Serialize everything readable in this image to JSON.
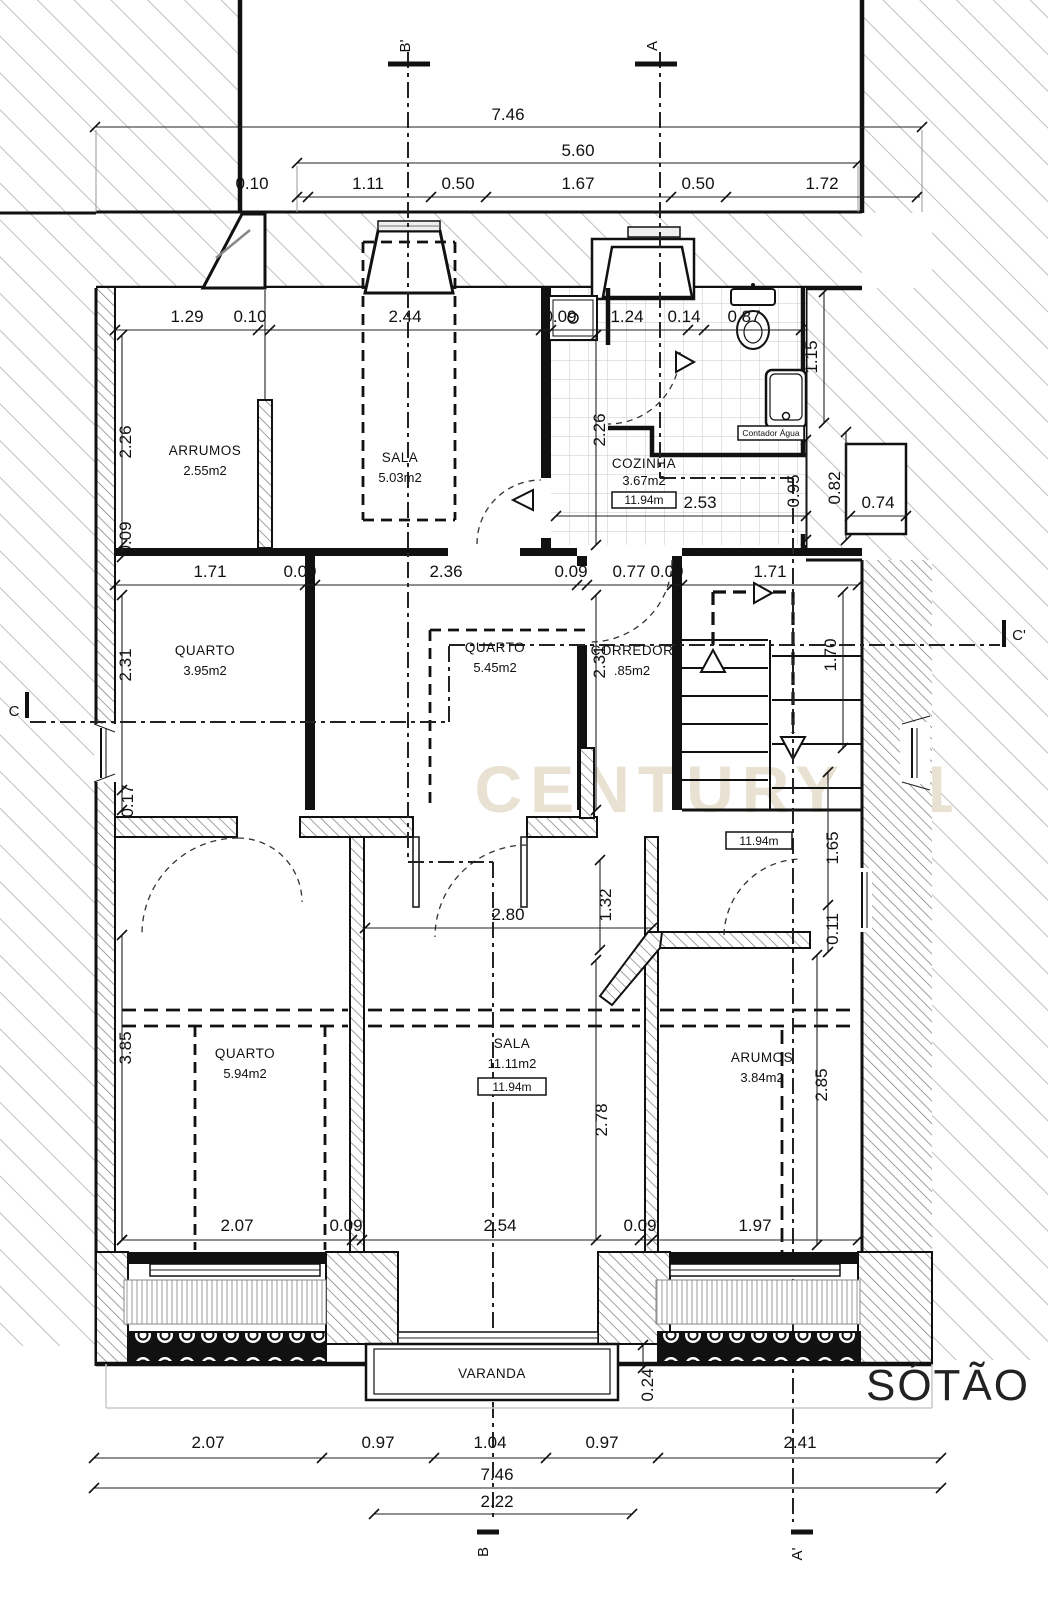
{
  "drawing": {
    "floor_label": "SÓTÃO",
    "watermark": "CENTURY 21",
    "rooms": {
      "arrumos_top": {
        "name": "ARRUMOS",
        "area": "2.55m2"
      },
      "sala_top": {
        "name": "SALA",
        "area": "5.03m2"
      },
      "cozinha": {
        "name": "COZINHA",
        "area": "3.67m2",
        "ceiling_height": "11.94m"
      },
      "quarto_nw": {
        "name": "QUARTO",
        "area": "3.95m2"
      },
      "quarto_mid": {
        "name": "QUARTO",
        "area": "5.45m2"
      },
      "corredor": {
        "name": "CORREDOR",
        "area": ".85m2"
      },
      "hall": {
        "ceiling_height": "11.94m"
      },
      "quarto_sw": {
        "name": "QUARTO",
        "area": "5.94m2"
      },
      "sala_main": {
        "name": "SALA",
        "area": "11.11m2",
        "ceiling_height": "11.94m"
      },
      "arumos": {
        "name": "ARUMOS",
        "area": "3.84m2"
      },
      "varanda": {
        "name": "VARANDA"
      }
    },
    "annotations": {
      "water_meter": "Contador Água"
    },
    "section_markers": {
      "b_top": "B'",
      "a_top": "A",
      "c_left": "C",
      "c_right": "C'",
      "b_bottom": "B",
      "a_bottom": "A'"
    },
    "dimensions": {
      "total_width_top": "7.46",
      "inner_width_top": "5.60",
      "row_top": [
        "0.10",
        "1.11",
        "0.50",
        "1.67",
        "0.50",
        "1.72"
      ],
      "row_upper": [
        "1.29",
        "0.10",
        "2.44",
        "0.09",
        "1.24",
        "0.14",
        "0.87"
      ],
      "v_left_upper": [
        "2.26",
        "0.09"
      ],
      "v_mid_upper": "2.26",
      "v_right_upper": [
        "1.15",
        "0.95",
        "0.82"
      ],
      "kitchen_width": "2.53",
      "alcove_width": "0.74",
      "row_mid": [
        "1.71",
        "0.09",
        "2.36",
        "0.09",
        "0.77",
        "0.09",
        "1.71"
      ],
      "v_left_mid": [
        "2.31",
        "0.17"
      ],
      "v_mid_mid": "2.31",
      "stair_depth": "1.70",
      "v_low": [
        "1.32",
        "1.65",
        "0.11",
        "3.85",
        "2.78",
        "2.85"
      ],
      "opening_width": "2.80",
      "balcony_depth": "0.24",
      "row_lower": [
        "2.07",
        "0.09",
        "2.54",
        "0.09",
        "1.97"
      ],
      "row_bottom": [
        "2.07",
        "0.97",
        "1.04",
        "0.97",
        "2.41"
      ],
      "total_width_bottom": "7.46",
      "balcony_door_width": "2.22"
    },
    "colors": {
      "ink": "#1a1a1a",
      "hatch": "#b0b0b0",
      "wall_hatch": "#787878",
      "tile": "#c9c9c9",
      "watermark": "#e9e2d3"
    }
  }
}
